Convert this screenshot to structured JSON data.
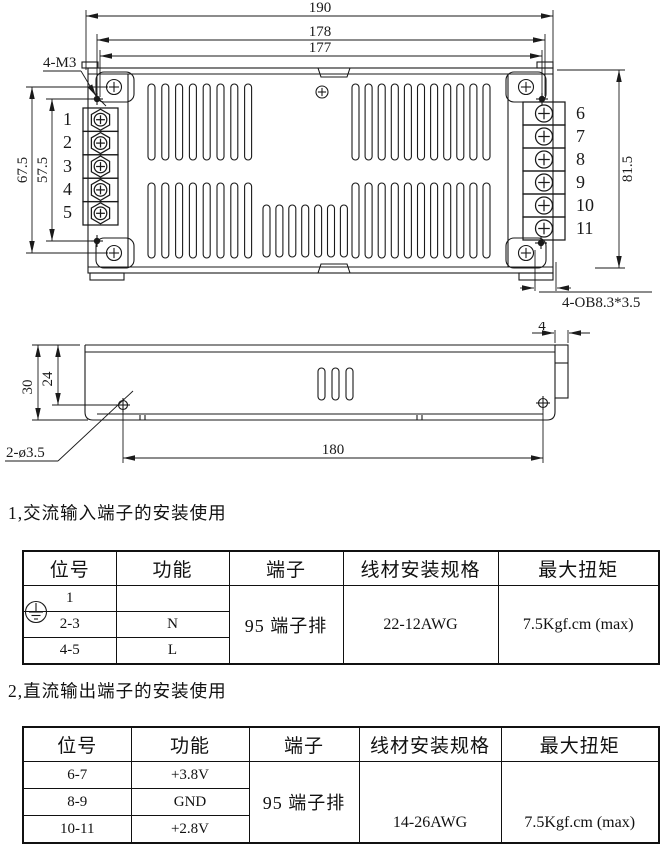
{
  "colors": {
    "ink": "#1a1a1a",
    "paper": "#ffffff"
  },
  "top_view": {
    "dim_190": "190",
    "dim_178": "178",
    "dim_177": "177",
    "label_4m3": "4-M3",
    "dim_67_5": "67.5",
    "dim_57_5": "57.5",
    "dim_81_5": "81.5",
    "label_oblong": "4-OB8.3*3.5",
    "left_terminals": [
      "1",
      "2",
      "3",
      "4",
      "5"
    ],
    "right_terminals": [
      "6",
      "7",
      "8",
      "9",
      "10",
      "11"
    ]
  },
  "side_view": {
    "dim_4": "4",
    "dim_30": "30",
    "dim_24": "24",
    "label_hole": "2-ø3.5",
    "dim_180": "180"
  },
  "sections": {
    "ac": {
      "heading": "1,交流输入端子的安装使用"
    },
    "dc": {
      "heading": "2,直流输出端子的安装使用"
    }
  },
  "tables": {
    "headers": [
      "位号",
      "功能",
      "端子",
      "线材安装规格",
      "最大扭矩"
    ],
    "ac": {
      "rows": [
        {
          "pos": "1",
          "func_icon": "protective-earth"
        },
        {
          "pos": "2-3",
          "func": "N"
        },
        {
          "pos": "4-5",
          "func": "L"
        }
      ],
      "terminal": "95 端子排",
      "wire": "22-12AWG",
      "torque": "7.5Kgf.cm (max)"
    },
    "dc": {
      "rows": [
        {
          "pos": "6-7",
          "func": "+3.8V"
        },
        {
          "pos": "8-9",
          "func": "GND"
        },
        {
          "pos": "10-11",
          "func": "+2.8V"
        }
      ],
      "terminal": "95 端子排",
      "wire": "14-26AWG",
      "torque": "7.5Kgf.cm (max)"
    }
  }
}
